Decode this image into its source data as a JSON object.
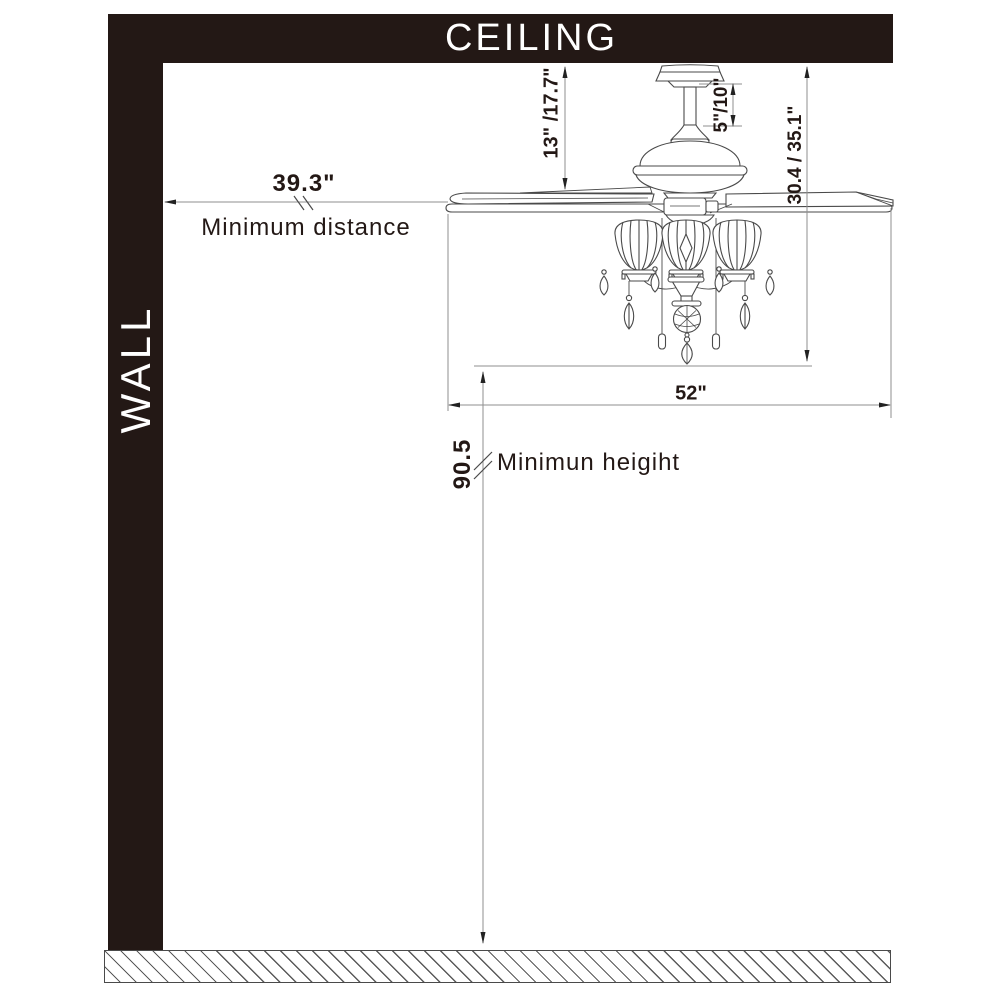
{
  "scene": {
    "ceiling": "CEILING",
    "wall": "WALL"
  },
  "dims": {
    "ceiling_to_blade": "13\" /17.7\"",
    "downrod": "5\"/10\"",
    "ceiling_to_bottom": "30.4 / 35.1\"",
    "wall_distance": "39.3\"",
    "wall_distance_label": "Minimum distance",
    "blade_sweep": "52\"",
    "floor_height": "90.5",
    "floor_height_label": "Minimun heigiht"
  }
}
